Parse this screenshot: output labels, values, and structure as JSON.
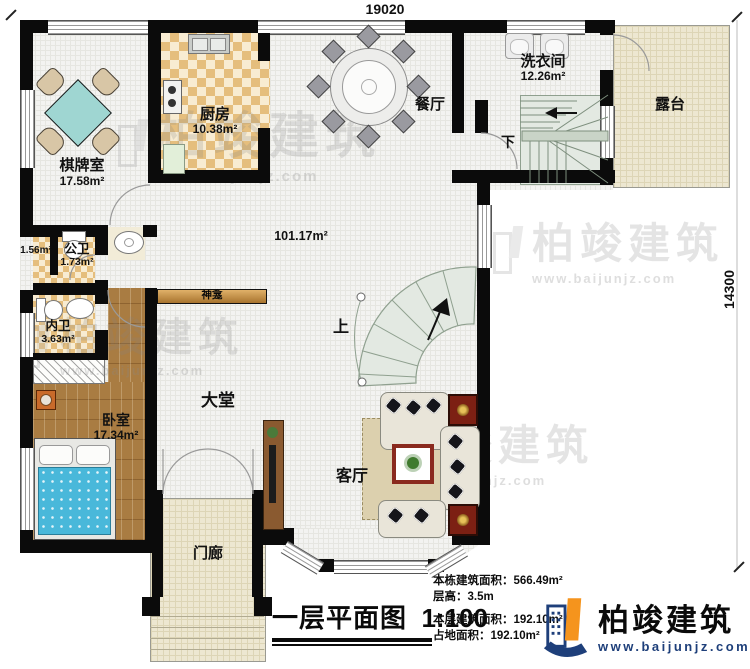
{
  "dimensions": {
    "width": "19020",
    "height": "14300"
  },
  "rooms": {
    "chess": {
      "name": "棋牌室",
      "area": "17.58m²"
    },
    "kitchen": {
      "name": "厨房",
      "area": "10.38m²"
    },
    "dining": {
      "name": "餐厅"
    },
    "laundry": {
      "name": "洗衣间",
      "area": "12.26m²"
    },
    "terrace": {
      "name": "露台"
    },
    "hall": {
      "area": "101.17m²"
    },
    "closet": {
      "area": "1.56m²"
    },
    "public_bath": {
      "name": "公卫",
      "area": "1.73m²"
    },
    "inner_bath": {
      "name": "内卫",
      "area": "3.63m²"
    },
    "bedroom": {
      "name": "卧室",
      "area": "17.34m²"
    },
    "lobby": {
      "name": "大堂"
    },
    "living": {
      "name": "客厅"
    },
    "porch": {
      "name": "门廊"
    },
    "shrine": {
      "name": "神龛"
    },
    "stairs_up": {
      "label": "上"
    },
    "stairs_down": {
      "label": "下"
    }
  },
  "title_block": {
    "title": "一层平面图",
    "scale": "1:100",
    "stats": [
      {
        "label": "本栋建筑面积：",
        "value": "566.49m²"
      },
      {
        "label": "层高：",
        "value": "3.5m"
      },
      {
        "label": "本层建筑面积：",
        "value": "192.10m²"
      },
      {
        "label": "占地面积：",
        "value": "192.10m²"
      }
    ]
  },
  "brand": {
    "name": "柏竣建筑",
    "url": "www.baijunjz.com"
  },
  "watermark": {
    "name": "柏竣建筑",
    "url": "www.baijunjz.com"
  },
  "colors": {
    "wall": "#0b0b0b",
    "brand_navy": "#1e3f7a",
    "brand_orange": "#f5941d"
  }
}
